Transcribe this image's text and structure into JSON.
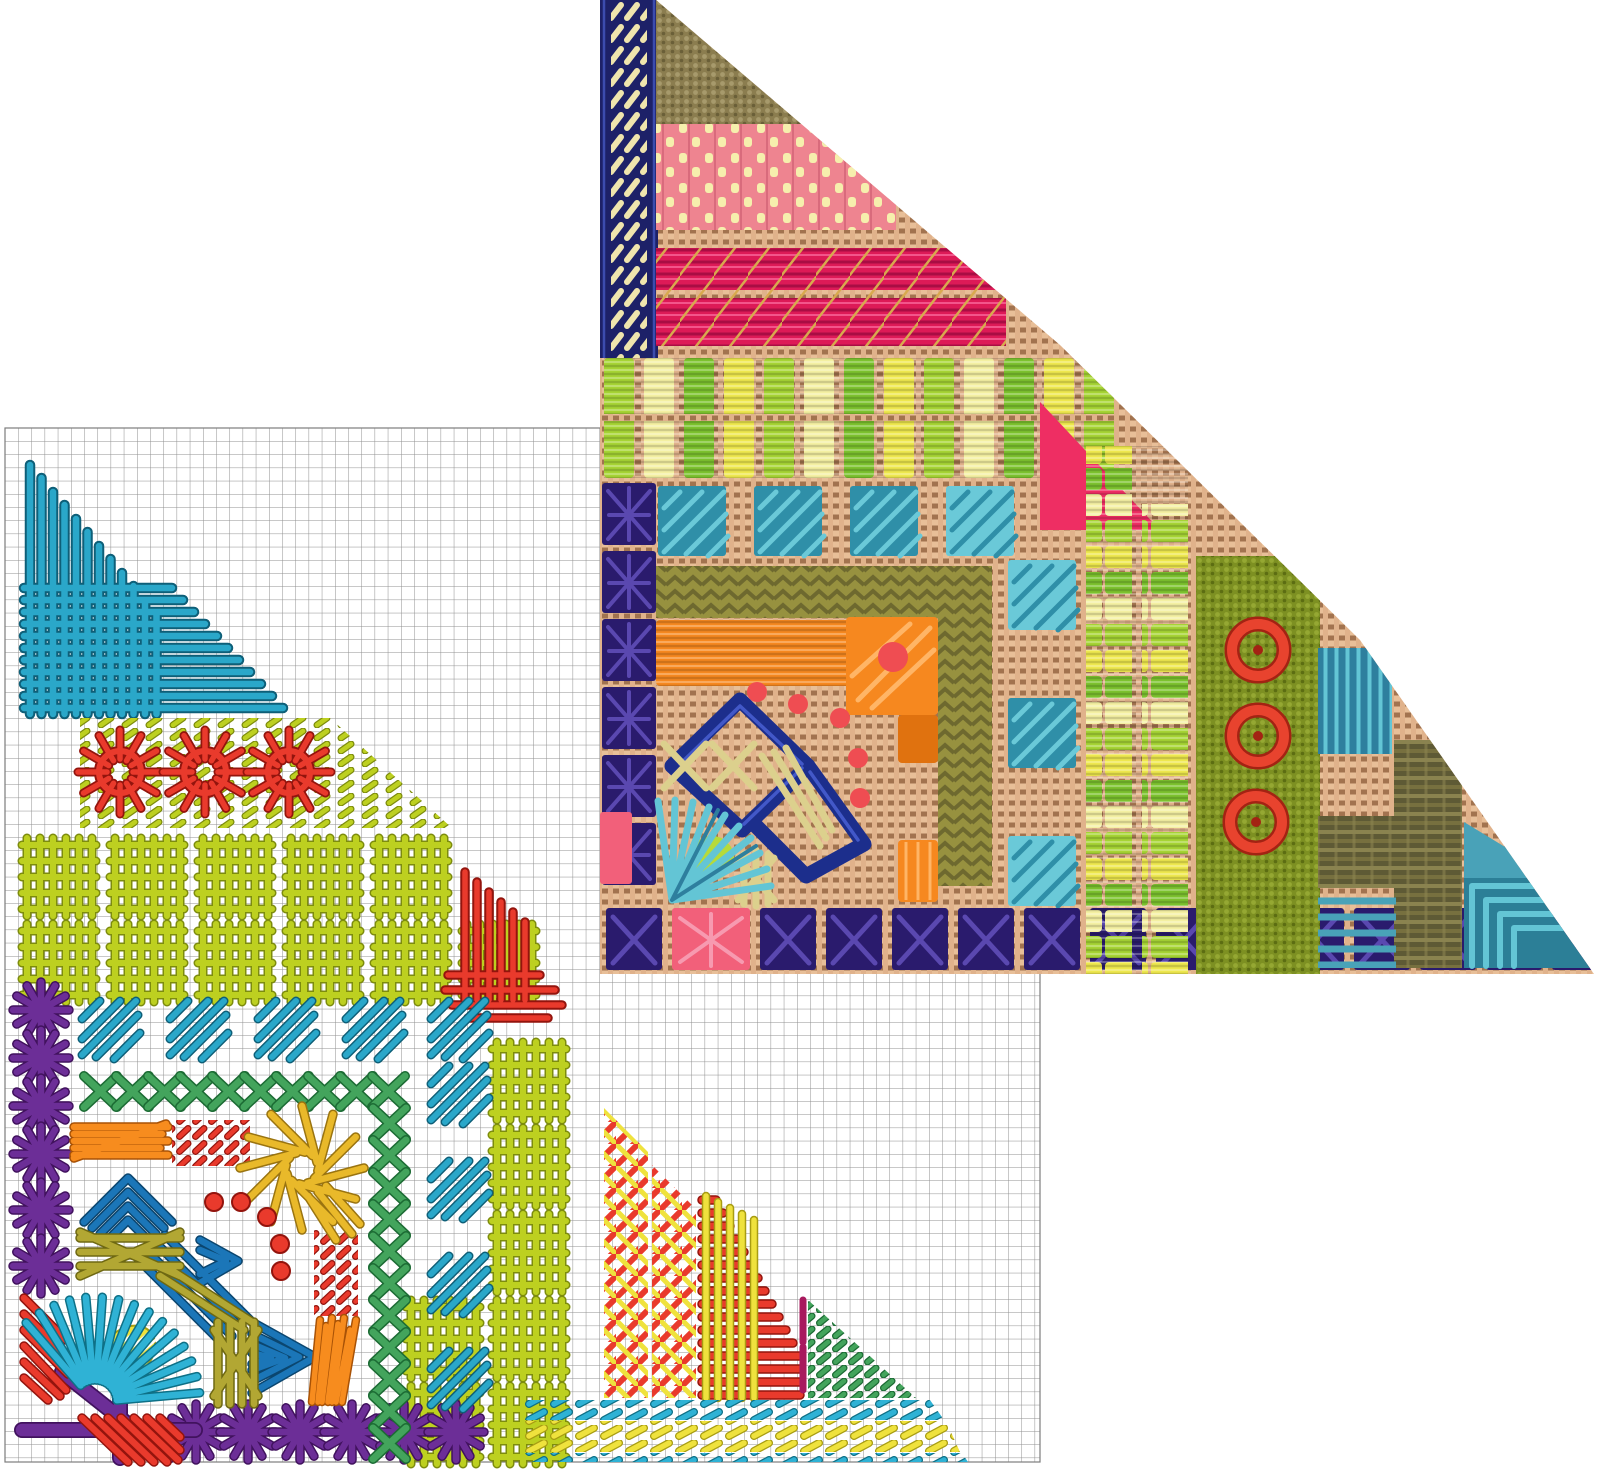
{
  "meta": {
    "title": "Needlepoint corner sampler: stitched model photograph (top right triangle) overlapping its counted stitch chart (bottom left)",
    "image_type": "composite craft diagram and photo",
    "background": "#ffffff",
    "no_visible_text": true
  },
  "palette": {
    "grid_line": "#8f8f8f",
    "chart_teal": "#2aa7c9",
    "chart_teal_d": "#0e5f78",
    "chart_chartreuse": "#bdd020",
    "chart_chartreuse_d": "#7d8c0d",
    "chart_red": "#e93a2c",
    "chart_red_d": "#93140d",
    "chart_purple": "#6c2e97",
    "chart_purple_d": "#41125e",
    "chart_green": "#43a45c",
    "chart_green_d": "#1c6b34",
    "chart_royal": "#1b76b8",
    "chart_royal_d": "#0b466f",
    "chart_olive": "#b2a733",
    "chart_olive_d": "#6e6812",
    "chart_gold": "#e9b92a",
    "chart_gold_d": "#9a7410",
    "chart_orange": "#f78c1e",
    "chart_orange_d": "#a85206",
    "chart_yellow": "#efe23d",
    "chart_yellow_d": "#a89d12",
    "chart_cyan": "#2fb2d5",
    "chart_cyan_d": "#0e7086",
    "chart_magenta": "#a81a5e",
    "canvas_base": "#c69972",
    "canvas_warp": "#e0b28b",
    "canvas_weft": "#e8bf98",
    "canvas_hole": "#a2734f",
    "navy": "#1d2168",
    "navy_light": "#3c4cae",
    "cream": "#efe5ad",
    "tentbrown": "#8b7d4f",
    "tentbrown_hi": "#a79a6c",
    "tentbrown_sh": "#6a5f38",
    "salmon": "#ee8490",
    "salmon_d": "#d96b7c",
    "paleyellow": "#f6efad",
    "crimson": "#dd1a57",
    "crimson_d": "#a90d44",
    "crimson_hi": "#f3558b",
    "goldthread": "#d8a94e",
    "lime": "#a6d434",
    "grass": "#7cc22e",
    "butter": "#eee84e",
    "pale": "#f4f0a2",
    "hotpink": "#ee2e63",
    "tealsq": "#2f8fa8",
    "tealsq_light": "#6ac9d8",
    "deeppurple": "#2a1b6d",
    "spider_light": "#5a48b0",
    "olivebase": "#97913f",
    "olivedark": "#6e692f",
    "orange_photo": "#f6881f",
    "orange_deep": "#e0720f",
    "coral": "#ef4d52",
    "navy_metal": "#1c2e8c",
    "navy_sheen": "#4258c8",
    "straw": "#dcd08d",
    "aqua": "#63c5d5",
    "limeleaf": "#b6da3a",
    "pinkblock": "#f2607a",
    "pink_hi": "#f79ab0",
    "olivefield": "#7d9022",
    "olivefield_hi": "#95a833",
    "olivefield_sh": "#5c6d12",
    "redwheel": "#e8432e",
    "redwheel_d": "#a32313",
    "tealdark": "#2e7f9e",
    "tealmid": "#49a2b8",
    "brown": "#5e5a35",
    "brown_hi": "#8a834f",
    "brown_mid": "#77703f",
    "aquadeep": "#2c7f97"
  },
  "chart": {
    "position": "bottom-left",
    "description": "Counted stitch chart of one mitered corner of the sampler, drawn as coloured thread symbols on a square grid",
    "background": "#ffffff",
    "grid": {
      "cell_px": 13.2,
      "cols": 78,
      "rows": 78,
      "line_color_key": "grid_line"
    },
    "motifs": [
      {
        "name": "teal-crosshatch-fan",
        "colors": [
          "chart_teal"
        ],
        "stitch": "long vertical and horizontal straight stitches woven into a fan"
      },
      {
        "name": "chartreuse-tick-field",
        "colors": [
          "chart_chartreuse"
        ],
        "stitch": "diagonal darning ticks"
      },
      {
        "name": "red-spider-stars",
        "count": 3,
        "colors": [
          "chart_red"
        ],
        "stitch": "ribbed spider-web wheels"
      },
      {
        "name": "chartreuse-woven-blocks",
        "count": 18,
        "colors": [
          "chart_chartreuse"
        ],
        "stitch": "woven square blocks"
      },
      {
        "name": "red-mini-fan",
        "colors": [
          "chart_red"
        ],
        "stitch": "small crosshatch fan"
      },
      {
        "name": "purple-asterisk-border",
        "count": 12,
        "colors": [
          "chart_purple"
        ],
        "stitch": "star / Smyrna asterisks along left edge and bottom"
      },
      {
        "name": "purple-corner-cross",
        "colors": [
          "chart_purple"
        ],
        "stitch": "large corner cross stitch"
      },
      {
        "name": "red-diagonal-blocks",
        "count": 2,
        "colors": [
          "chart_red"
        ],
        "stitch": "slanted straight stitch blocks"
      },
      {
        "name": "teal-diagonal-patches",
        "count": 9,
        "colors": [
          "chart_teal"
        ],
        "stitch": "diagonal satin patches in an L"
      },
      {
        "name": "green-lattice-band",
        "colors": [
          "chart_green"
        ],
        "stitch": "crossed lattice band in an L"
      },
      {
        "name": "orange-bar-block",
        "colors": [
          "chart_orange"
        ],
        "stitch": "horizontal straight stitches"
      },
      {
        "name": "red-dash-fields",
        "count": 2,
        "colors": [
          "chart_red"
        ],
        "stitch": "rows of short diagonal dashes"
      },
      {
        "name": "gold-teardrop-fan",
        "colors": [
          "chart_gold"
        ],
        "stitch": "spiral teardrop fan"
      },
      {
        "name": "royal-chevron-cascade",
        "colors": [
          "chart_royal"
        ],
        "stitch": "nested chevrons stepping down the miter"
      },
      {
        "name": "olive-crossed-block",
        "colors": [
          "chart_olive"
        ],
        "stitch": "straight stitches with large crosses"
      },
      {
        "name": "red-dot-arc",
        "count": 5,
        "colors": [
          "chart_red"
        ],
        "stitch": "french-knot dots"
      },
      {
        "name": "cyan-teardrop-fan",
        "colors": [
          "chart_cyan",
          "chart_yellow"
        ],
        "stitch": "ray fan around yellow teardrop"
      },
      {
        "name": "orange-slant-block",
        "colors": [
          "chart_orange"
        ],
        "stitch": "steep slanted stitches"
      },
      {
        "name": "red-yellow-lattice-columns",
        "count": 2,
        "colors": [
          "chart_red",
          "chart_yellow"
        ],
        "stitch": "plaited lattice columns"
      },
      {
        "name": "red-comb-triangle",
        "colors": [
          "chart_red",
          "chart_yellow",
          "chart_magenta"
        ],
        "stitch": "graduated ladder with woven yellow uprights and magenta caps"
      },
      {
        "name": "green-tick-triangle",
        "colors": [
          "chart_green"
        ],
        "stitch": "diagonal tick triangle"
      },
      {
        "name": "cyan-yellow-dash-rows",
        "colors": [
          "chart_cyan",
          "chart_yellow"
        ],
        "stitch": "border rows of slanted dashes"
      }
    ]
  },
  "photo": {
    "position": "top-right",
    "shape": "right triangle, hypotenuse running from top left down to bottom right corner",
    "description": "Photograph of the same corner stitched on tan mono canvas",
    "canvas_color_key": "canvas_base",
    "patches": [
      {
        "name": "navy-herringbone-border",
        "colors": [
          "navy",
          "cream"
        ]
      },
      {
        "name": "brown-tent-block",
        "colors": [
          "tentbrown"
        ]
      },
      {
        "name": "salmon-woven-band",
        "colors": [
          "salmon",
          "paleyellow"
        ]
      },
      {
        "name": "crimson-rows-band",
        "colors": [
          "crimson",
          "goldthread"
        ]
      },
      {
        "name": "lime-yellow-bar-band",
        "colors": [
          "lime",
          "grass",
          "butter",
          "pale"
        ]
      },
      {
        "name": "hot-pink-patch",
        "colors": [
          "hotpink"
        ]
      },
      {
        "name": "teal-checker-squares",
        "colors": [
          "tealsq",
          "tealsq_light"
        ]
      },
      {
        "name": "purple-spider-border",
        "colors": [
          "deeppurple",
          "spider_light"
        ]
      },
      {
        "name": "olive-herringbone-L",
        "colors": [
          "olivebase",
          "olivedark"
        ]
      },
      {
        "name": "orange-corner-L",
        "colors": [
          "orange_photo",
          "orange_deep",
          "coral"
        ]
      },
      {
        "name": "red-dot-arc",
        "colors": [
          "coral"
        ]
      },
      {
        "name": "navy-metallic-chevron",
        "colors": [
          "navy_metal",
          "navy_sheen"
        ]
      },
      {
        "name": "straw-cross-block",
        "colors": [
          "straw"
        ]
      },
      {
        "name": "aqua-teardrop-fan",
        "colors": [
          "aqua",
          "limeleaf"
        ]
      },
      {
        "name": "pink-edge-blocks",
        "colors": [
          "pinkblock"
        ]
      },
      {
        "name": "navy-x-bottom-border",
        "colors": [
          "deeppurple",
          "pinkblock"
        ]
      },
      {
        "name": "lime-yellow-stacked-columns",
        "colors": [
          "lime",
          "butter",
          "grass",
          "pale"
        ]
      },
      {
        "name": "olive-tent-field",
        "colors": [
          "olivefield"
        ]
      },
      {
        "name": "red-wheel-stitches",
        "count": 3,
        "colors": [
          "redwheel"
        ]
      },
      {
        "name": "teal-vertical-block",
        "colors": [
          "tealdark",
          "aqua"
        ]
      },
      {
        "name": "brown-woven-L",
        "colors": [
          "brown",
          "brown_hi"
        ]
      },
      {
        "name": "teal-stripe-block",
        "colors": [
          "tealmid"
        ]
      },
      {
        "name": "aqua-mitered-corner-square",
        "colors": [
          "aquadeep",
          "aqua"
        ]
      }
    ]
  }
}
